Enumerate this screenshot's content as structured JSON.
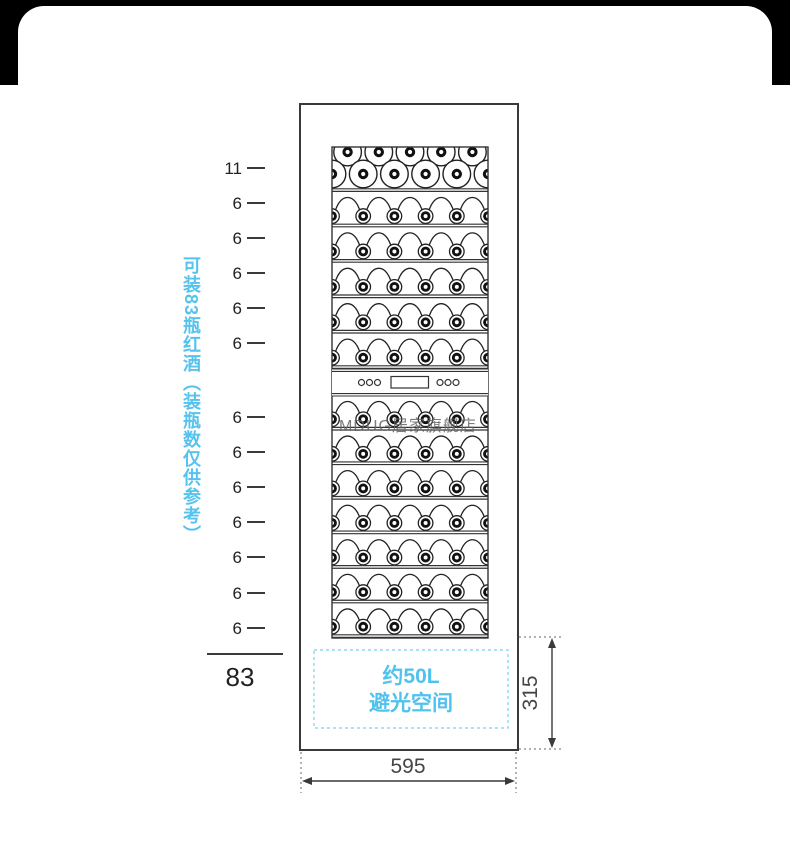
{
  "colors": {
    "accent_cyan": "#56c3ef",
    "line_dark": "#3a3a3a",
    "text_dark": "#222222",
    "dim_text": "#454545",
    "watermark_gray": "#666666",
    "dashed_box_border": "#8ed8f4",
    "top_band_black": "#000000"
  },
  "side_note": {
    "text": "可装83瓶红酒（装瓶数仅供参考）"
  },
  "capacity": {
    "ticks": [
      {
        "label": "11",
        "y": 168
      },
      {
        "label": "6",
        "y": 203
      },
      {
        "label": "6",
        "y": 238
      },
      {
        "label": "6",
        "y": 273
      },
      {
        "label": "6",
        "y": 308
      },
      {
        "label": "6",
        "y": 343
      },
      {
        "label": "6",
        "y": 417
      },
      {
        "label": "6",
        "y": 452
      },
      {
        "label": "6",
        "y": 487
      },
      {
        "label": "6",
        "y": 522
      },
      {
        "label": "6",
        "y": 557
      },
      {
        "label": "6",
        "y": 593
      },
      {
        "label": "6",
        "y": 628
      }
    ],
    "total_label": "83"
  },
  "chart_data": {
    "type": "table",
    "title": "可装83瓶红酒（装瓶数仅供参考）",
    "rows_bottle_counts": [
      11,
      6,
      6,
      6,
      6,
      6,
      6,
      6,
      6,
      6,
      6,
      6,
      6
    ],
    "total_bottles": 83,
    "cabinet_width_mm": 595,
    "dark_space_height_mm": 315,
    "dark_space_volume": "约50L"
  },
  "dark_space_box": {
    "line1": "约50L",
    "line2": "避光空间"
  },
  "dimensions": {
    "width": "595",
    "bottom_height": "315"
  },
  "watermark": {
    "text": "MDUG居家旗舰店"
  }
}
